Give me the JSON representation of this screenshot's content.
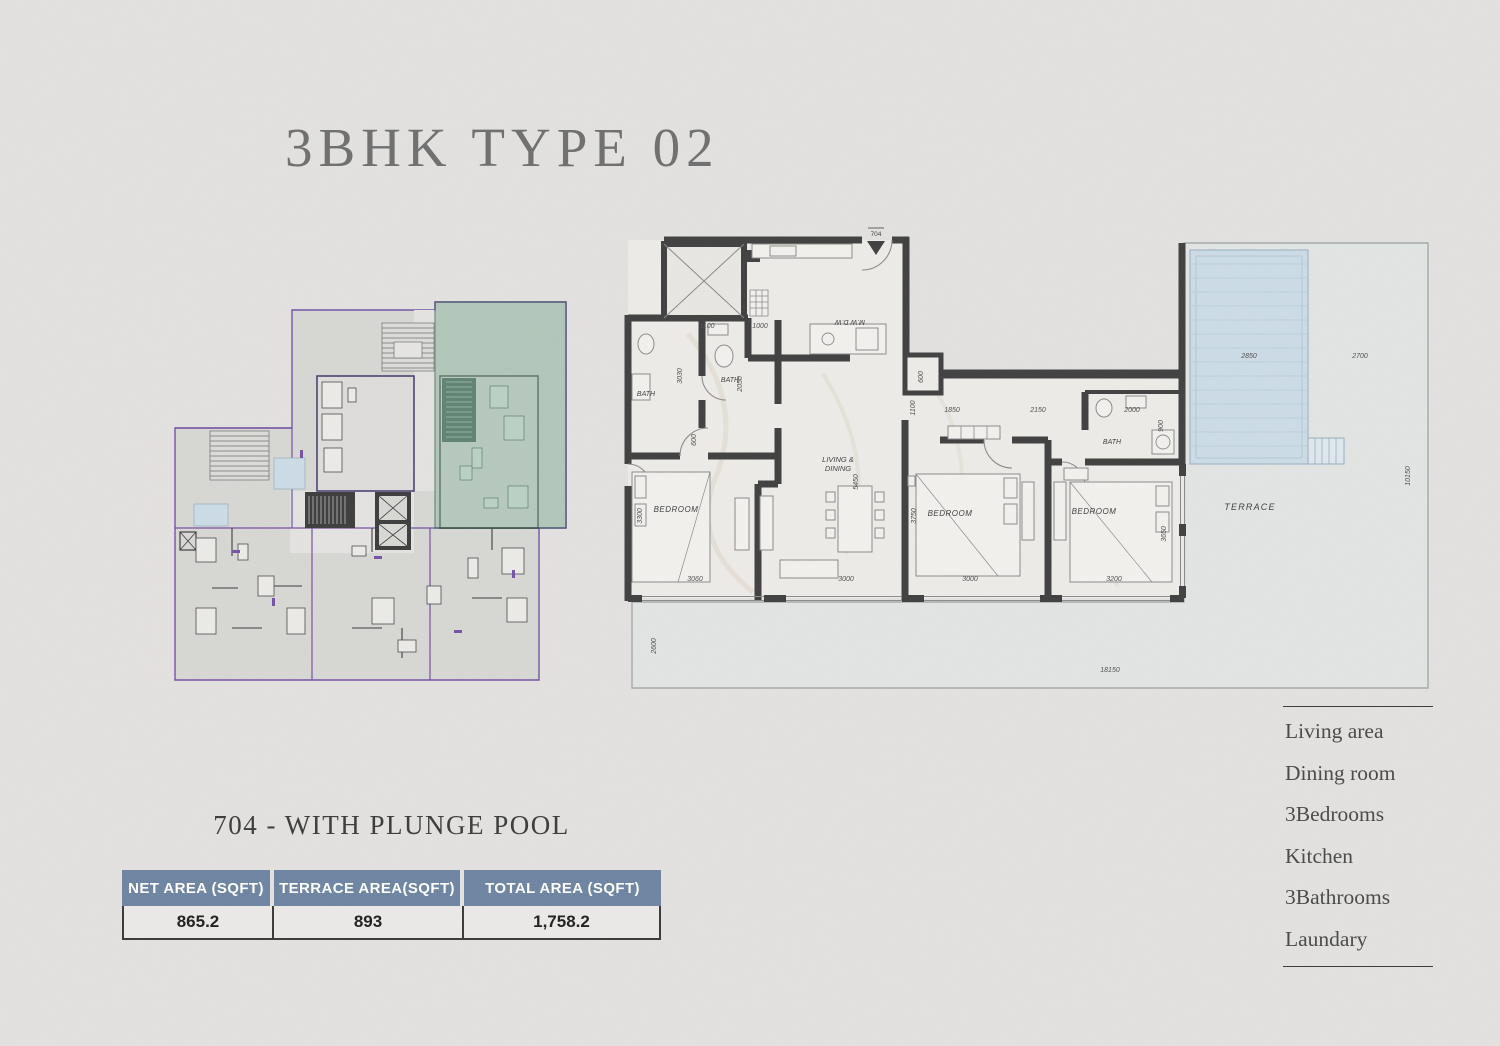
{
  "title": "3BHK TYPE 02",
  "unit": {
    "subtitle": "704 - WITH PLUNGE POOL",
    "number": "704"
  },
  "area_table": {
    "headers": [
      "NET AREA (SQFT)",
      "TERRACE AREA(SQFT)",
      "TOTAL AREA (SQFT)"
    ],
    "values": [
      "865.2",
      "893",
      "1,758.2"
    ]
  },
  "legend": {
    "items": [
      "Living area",
      "Dining room",
      "3Bedrooms",
      "Kitchen",
      "3Bathrooms",
      "Laundary"
    ]
  },
  "plan": {
    "entry_label": "704",
    "rooms": {
      "bath": "BATH",
      "bedroom": "BEDROOM",
      "living1": "LIVING &",
      "living2": "DINING",
      "terrace": "TERRACE",
      "appliances": "M.W D.W"
    },
    "dims": {
      "a1100": "1100",
      "a1000": "1000",
      "v3030": "3030",
      "v2050": "2050",
      "v600": "600",
      "v3300": "3300",
      "w3060": "3060",
      "v5450": "5450",
      "w3000a": "3000",
      "v3750": "3750",
      "w3000b": "3000",
      "v3650": "3650",
      "w3200": "3200",
      "v1100": "1100",
      "a1850": "1850",
      "a2150": "2150",
      "s600": "600",
      "w2000": "2000",
      "v900": "900",
      "pool": "2850",
      "t2700": "2700",
      "t10150": "10150",
      "t18150": "18150",
      "t2600": "2600"
    }
  },
  "colors": {
    "page_bg": "#e3e2e0",
    "wall": "#3f3f3f",
    "highlight_green": "#8fb7a2",
    "unit_outline_purple": "#7352a4",
    "pool_blue": "#ccdce6",
    "table_header_blue": "#6d84a1",
    "title_gray": "#6e6e6e"
  }
}
